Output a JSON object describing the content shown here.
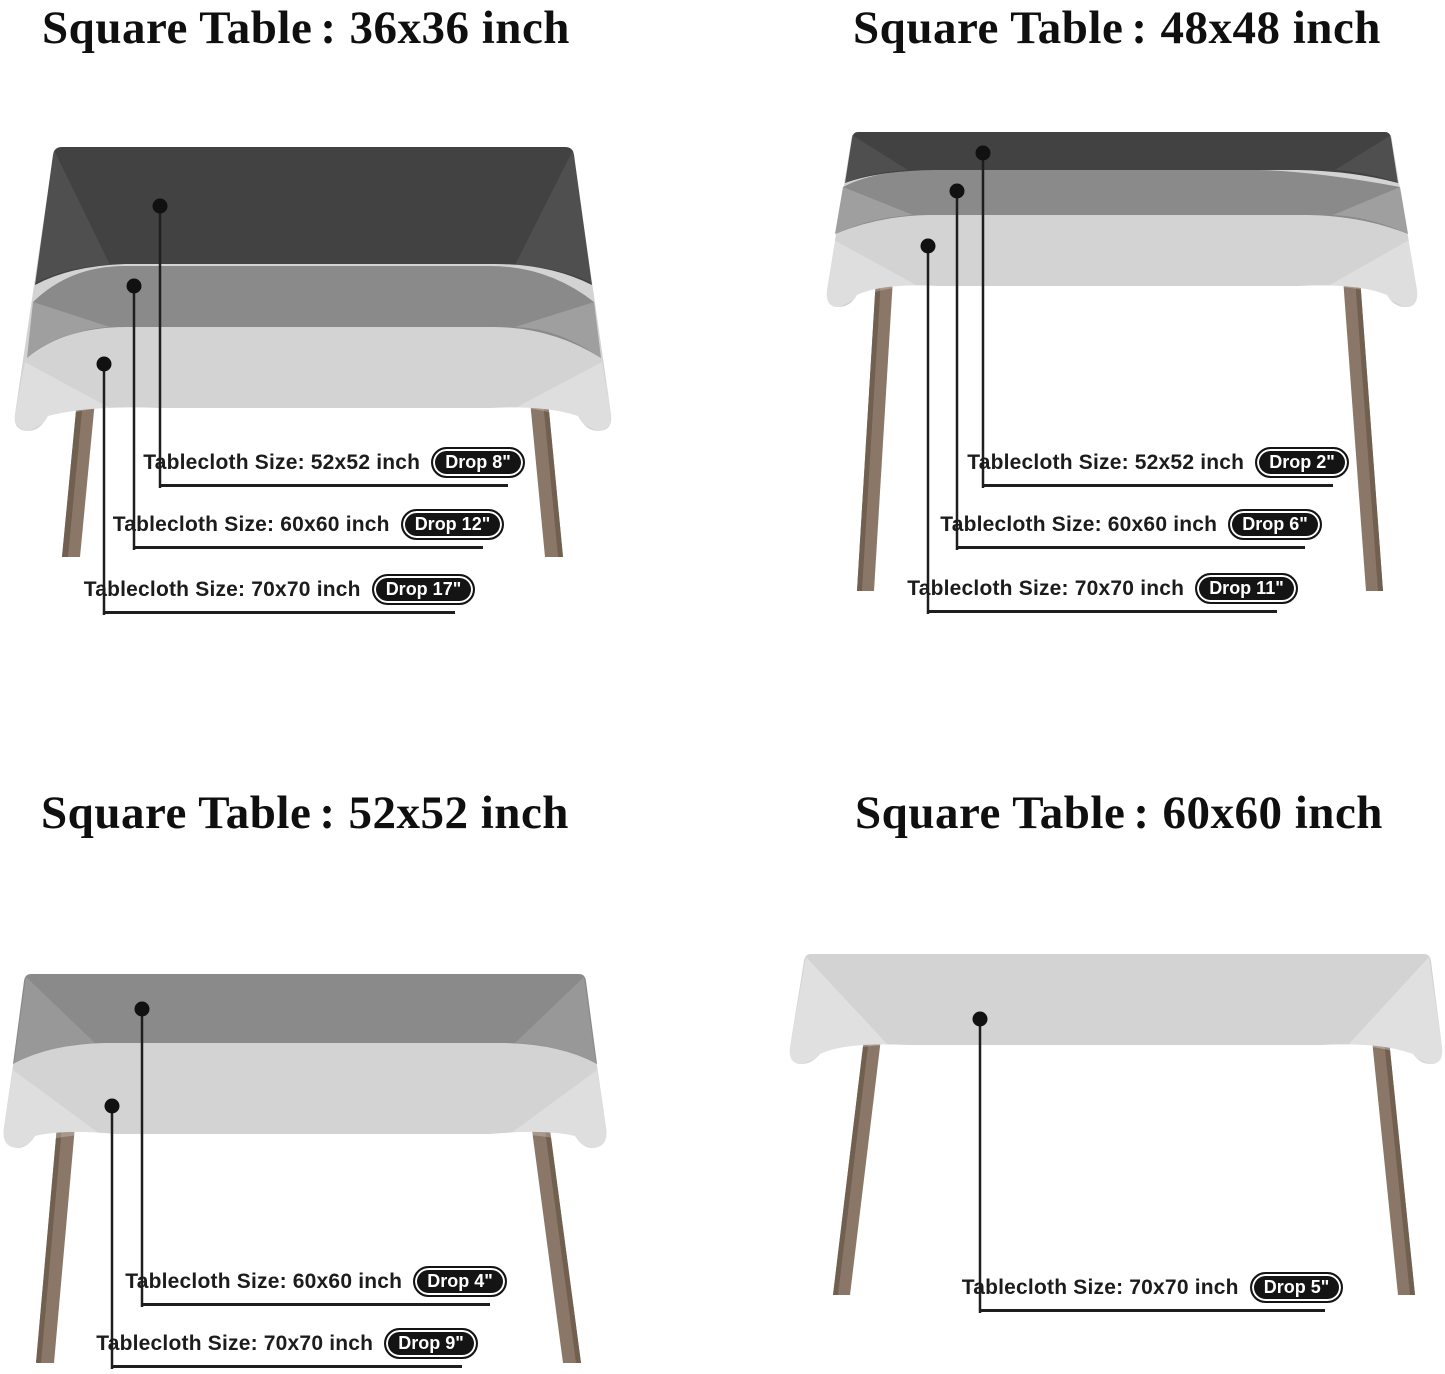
{
  "page": {
    "background": "#ffffff"
  },
  "colors": {
    "cloth_dark": "#424242",
    "cloth_medium": "#8a8a8a",
    "cloth_light": "#d3d3d3",
    "leg": "#8b7767",
    "leg_shadow": "#71604f",
    "line": "#1e1e1e",
    "dot": "#111111",
    "pill_bg": "#141414",
    "pill_text": "#ffffff",
    "title_color": "#0f0f0f",
    "label_color": "#1c1c1c"
  },
  "quadrants": [
    {
      "title": {
        "prefix": "Square Table",
        "sep": ":",
        "size": "36x36 inch"
      },
      "callouts": [
        {
          "label": "Tablecloth Size: 52x52 inch",
          "drop": "Drop 8\""
        },
        {
          "label": "Tablecloth Size: 60x60 inch",
          "drop": "Drop 12\""
        },
        {
          "label": "Tablecloth Size: 70x70 inch",
          "drop": "Drop 17\""
        }
      ]
    },
    {
      "title": {
        "prefix": "Square Table",
        "sep": ":",
        "size": "48x48 inch"
      },
      "callouts": [
        {
          "label": "Tablecloth Size: 52x52 inch",
          "drop": "Drop 2\""
        },
        {
          "label": "Tablecloth Size: 60x60 inch",
          "drop": "Drop 6\""
        },
        {
          "label": "Tablecloth Size: 70x70 inch",
          "drop": "Drop 11\""
        }
      ]
    },
    {
      "title": {
        "prefix": "Square Table",
        "sep": ":",
        "size": "52x52 inch"
      },
      "callouts": [
        {
          "label": "Tablecloth Size: 60x60 inch",
          "drop": "Drop 4\""
        },
        {
          "label": "Tablecloth Size: 70x70 inch",
          "drop": "Drop 9\""
        }
      ]
    },
    {
      "title": {
        "prefix": "Square Table",
        "sep": ":",
        "size": "60x60 inch"
      },
      "callouts": [
        {
          "label": "Tablecloth Size: 70x70 inch",
          "drop": "Drop 5\""
        }
      ]
    }
  ]
}
